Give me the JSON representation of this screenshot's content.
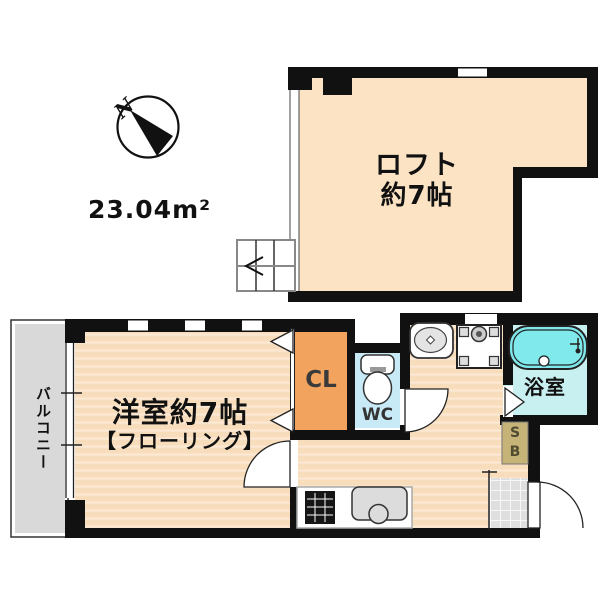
{
  "area_label": "23.04m²",
  "compass": {
    "north_label": "N"
  },
  "rooms": {
    "loft": {
      "name": "ロフト",
      "size": "約7帖"
    },
    "main": {
      "name": "洋室約7帖",
      "note": "【フローリング】"
    },
    "balcony": {
      "name": "バルコニー"
    },
    "closet": {
      "label": "CL"
    },
    "toilet": {
      "label": "WC"
    },
    "bathroom": {
      "name": "浴室"
    },
    "shoe_box": {
      "letters": [
        "S",
        "B"
      ]
    }
  },
  "icons": [
    "compass-icon",
    "stairs-icon",
    "toilet-icon",
    "washbasin-icon",
    "washing-machine-icon",
    "bathtub-icon",
    "stove-icon",
    "kitchen-sink-icon",
    "door-swing-icon",
    "folding-door-icon"
  ],
  "colors": {
    "wall": "#111111",
    "floor": "#F8DDBC",
    "stripe": "#FCE9D3",
    "loft": "#FBE3C3",
    "closet": "#F2A45F",
    "wc": "#C8E9F6",
    "bath": "#C9F0F1",
    "tub": "#80E9EC",
    "balcony": "#D9D9D9",
    "shoebox": "#C6B377",
    "genkan": "#DFDFDF"
  }
}
